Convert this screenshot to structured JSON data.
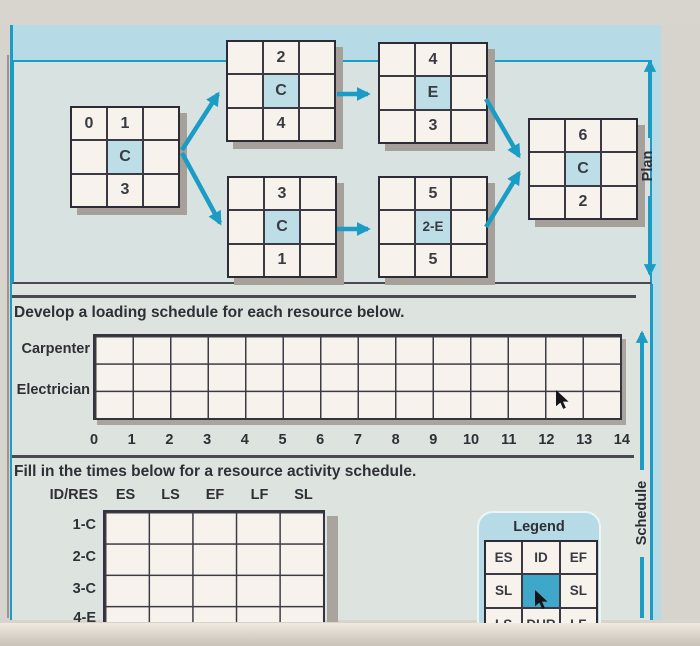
{
  "plan": {
    "side_label": "Plan",
    "nodes": [
      {
        "es": "0",
        "id": "1",
        "res": "C",
        "dur": "3"
      },
      {
        "id": "2",
        "res": "C",
        "dur": "4"
      },
      {
        "id": "3",
        "res": "C",
        "dur": "1"
      },
      {
        "id": "4",
        "res": "E",
        "dur": "3"
      },
      {
        "id": "5",
        "res": "2-E",
        "dur": "5"
      },
      {
        "id": "6",
        "res": "C",
        "dur": "2"
      }
    ]
  },
  "loading": {
    "instruction": "Develop a loading schedule for each resource below.",
    "rows": [
      "Carpenter",
      "Electrician"
    ],
    "axis": [
      "0",
      "1",
      "2",
      "3",
      "4",
      "5",
      "6",
      "7",
      "8",
      "9",
      "10",
      "11",
      "12",
      "13",
      "14"
    ],
    "grid_columns": 14,
    "grid_rows": 3
  },
  "schedule": {
    "side_label": "Schedule",
    "instruction": "Fill in the times below for a resource activity schedule.",
    "columns": [
      "ID/RES",
      "ES",
      "LS",
      "EF",
      "LF",
      "SL"
    ],
    "row_labels": [
      "1-C",
      "2-C",
      "3-C",
      "4-E"
    ]
  },
  "legend": {
    "title": "Legend",
    "cells": [
      [
        "ES",
        "ID",
        "EF"
      ],
      [
        "SL",
        "",
        "SL"
      ],
      [
        "LS",
        "DUR",
        "LF"
      ]
    ]
  },
  "colors": {
    "accent_teal": "#1b9cc5",
    "panel_blue": "#b7dbe6",
    "node_fill": "#f7f3ec",
    "node_resource_fill": "#bedee7",
    "legend_center_fill": "#3fa7c9",
    "grid_line": "#35343e",
    "background": "#d7d3cd"
  }
}
